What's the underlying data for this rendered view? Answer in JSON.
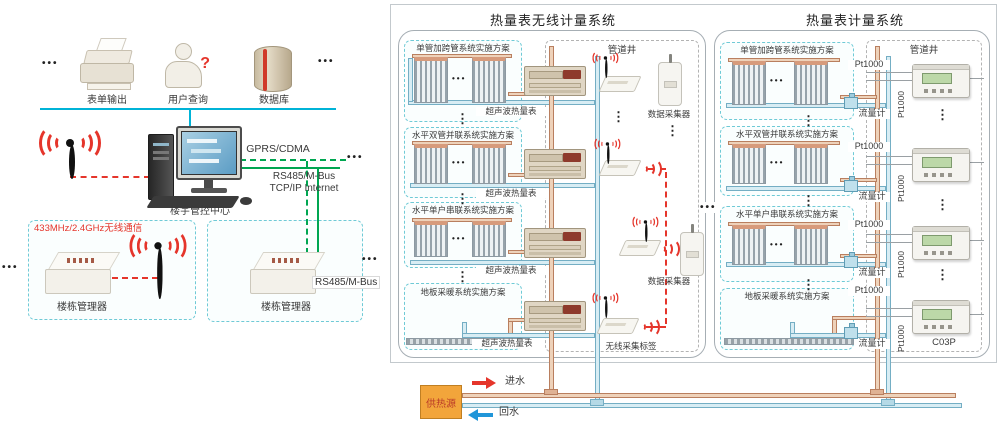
{
  "glyphs": {
    "dots": "•••",
    "vdots": "⋮",
    "qmark": "?"
  },
  "left": {
    "outputs": [
      {
        "label": "表单输出",
        "icon": "printer"
      },
      {
        "label": "用户查询",
        "icon": "user-query"
      },
      {
        "label": "数据库",
        "icon": "database"
      }
    ],
    "center_label": "楼宇管控中心",
    "gprs": "GPRS/CDMA",
    "rs485": "RS485/M-Bus",
    "tcpip": "TCP/IP Internet",
    "wireless_433": "433MHz/2.4GHz无线通信",
    "manager_left": "楼栋管理器",
    "manager_right": "楼栋管理器",
    "rs485_chip": "RS485/M-Bus"
  },
  "wireless": {
    "title": "热量表无线计量系统",
    "schemes": [
      "单管加跨管系统实施方案",
      "水平双管并联系统实施方案",
      "水平单户串联系统实施方案",
      "地板采暖系统实施方案"
    ],
    "meter": "超声波热量表",
    "well": "管道井",
    "collector": "数据采集器",
    "tag": "无线采集标签"
  },
  "wired": {
    "title": "热量表计量系统",
    "schemes": [
      "单管加跨管系统实施方案",
      "水平双管并联系统实施方案",
      "水平单户串联系统实施方案",
      "地板采暖系统实施方案"
    ],
    "well": "管道井",
    "pt1000": "Pt1000",
    "flow": "流量计",
    "model": "C03P"
  },
  "bottom": {
    "source": "供热源",
    "inflow": "进水",
    "outflow": "回水"
  },
  "colors": {
    "teal": "#00b3d7",
    "green": "#00a651",
    "red": "#e5352b",
    "pipe_supply": "#b97f5f",
    "pipe_return": "#74aec4",
    "source_orange": "#f2a53b"
  }
}
